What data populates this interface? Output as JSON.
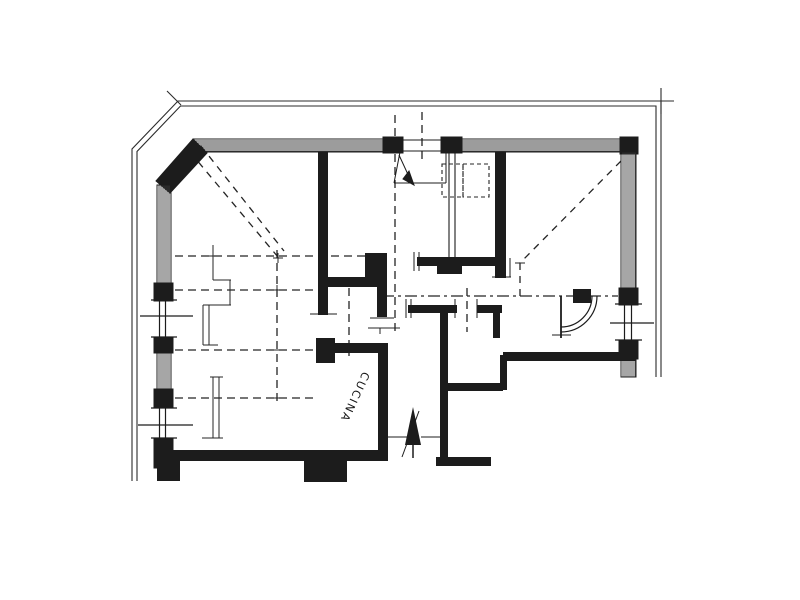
{
  "plan": {
    "room_label": "CUCINA",
    "ink_color": "#1c1c1c",
    "paper_color": "#ffffff",
    "symbols": {
      "entrance_arrow": "up-arrow through bottom doorway",
      "door_swing": "quarter-arc door swing, right side",
      "shaft": "dashed double rectangle near entrance",
      "ceiling_guides": "dashed diagonals in left and right rooms"
    }
  }
}
